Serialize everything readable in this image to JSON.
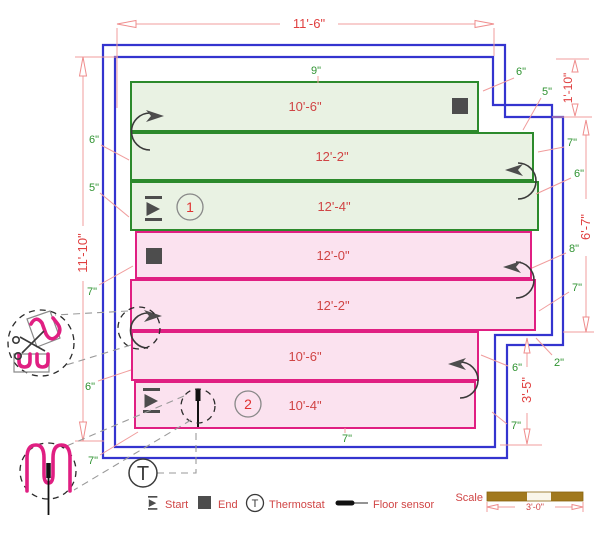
{
  "dims": {
    "top": "11'-6\"",
    "left": "11'-10\"",
    "right_top": "1'-10\"",
    "right_mid": "6'-7\"",
    "right_bottom": "3'-5\""
  },
  "offsets": {
    "top_center": "9\"",
    "top_right_a": "6\"",
    "top_right_b": "5\"",
    "left_a": "6\"",
    "left_b": "5\"",
    "left_c": "7\"",
    "left_d": "6\"",
    "left_e": "7\"",
    "right_a": "7\"",
    "right_b": "6\"",
    "right_c": "8\"",
    "right_d": "7\"",
    "right_e": "2\"",
    "right_f": "6\"",
    "right_g": "7\"",
    "bottom": "7\""
  },
  "zones": [
    {
      "number": "1",
      "bands": [
        "10'-6\"",
        "12'-2\"",
        "12'-4\""
      ]
    },
    {
      "number": "2",
      "bands": [
        "12'-0\"",
        "12'-2\"",
        "10'-6\"",
        "10'-4\""
      ]
    }
  ],
  "legend": {
    "start": "Start",
    "end": "End",
    "thermostat": "Thermostat",
    "thermostat_symbol": "T",
    "floor_sensor": "Floor sensor",
    "scale_label": "Scale",
    "scale_length": "3'-0\""
  },
  "colors": {
    "wall_blue": "#3434cf",
    "zone1_green": "#2c8a2c",
    "zone1_fill": "#e9f2e3",
    "zone2_pink": "#e01f82",
    "zone2_fill": "#fbe2ef",
    "dim_red": "#e04040",
    "leader_red": "#f09c9c",
    "label_green": "#2f9331",
    "scale_brown": "#a1791d",
    "marker_gray": "#4d4d4d"
  }
}
